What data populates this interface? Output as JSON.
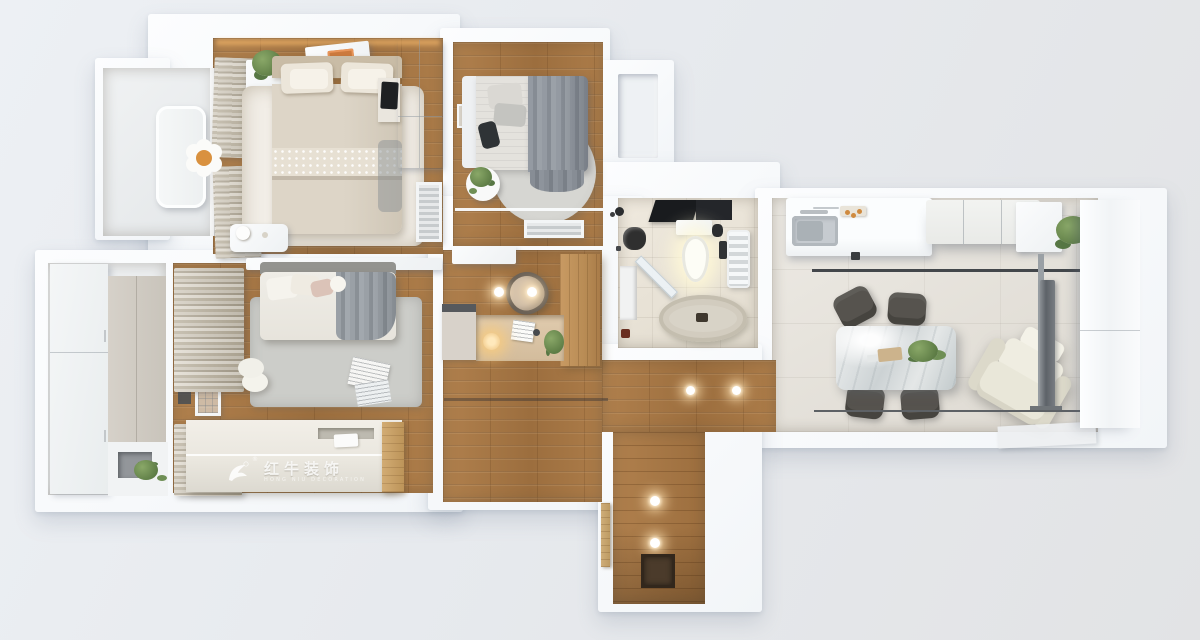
{
  "meta": {
    "scene": "3D top-down rendering of an apartment floor plan",
    "style": "white walls, warm wood and tile floors, photoreal furniture"
  },
  "watermark": {
    "logo": "red-bull-swoosh-logo",
    "registered_mark": "®",
    "brand": "红牛装饰",
    "tagline": "HONG NIU DECORATION"
  },
  "palette": {
    "background": "#e9ecf0",
    "wall": "#f8fafc",
    "wood_floor": "#a87846",
    "bathroom_tile": "#eae4d9",
    "living_tile": "#e7e4de",
    "balcony_floor": "#eceef0",
    "white_rug": "#f2eee7",
    "gray_rug": "#cbcbc7",
    "bed_beige": "#d7cec0",
    "blanket_gray": "#8e949a",
    "marble_table": "#dfe3e4",
    "chair_dark": "#56534e",
    "recliner_cream": "#edebe0",
    "accent_orange": "#cd7a3e",
    "greenery": "#6b8a50",
    "fixture_black": "#26282a",
    "watermark_text": "rgba(255,255,255,0.8)"
  },
  "rooms": [
    {
      "id": "master-bedroom",
      "label": "Master bedroom",
      "floor": "wood",
      "contents": [
        "double-bed",
        "pillows",
        "white-area-rug",
        "wardrobe",
        "bedside-shelf",
        "tablet",
        "curtains",
        "ceiling-light-panel",
        "led-cove-light",
        "potted-plant",
        "air-conditioner-grille",
        "low-side-table"
      ]
    },
    {
      "id": "north-balcony",
      "label": "North balcony",
      "floor": "light-tile",
      "contents": [
        "lounge-bench",
        "flower-stool"
      ]
    },
    {
      "id": "second-bedroom",
      "label": "Second bedroom",
      "floor": "wood",
      "contents": [
        "single-bed",
        "gray-striped-blanket",
        "round-rug",
        "round-side-table",
        "potted-plant",
        "wall-art",
        "window-sill",
        "floor-vent-grille"
      ]
    },
    {
      "id": "bathroom",
      "label": "Bathroom",
      "floor": "beige-tile",
      "contents": [
        "ceiling-exhaust",
        "toilet",
        "black-wash-basin",
        "diagonal-shower-screen",
        "corner-shelf",
        "towel-radiator",
        "oval-bath-mat"
      ]
    },
    {
      "id": "kitchen",
      "label": "Kitchen",
      "floor": "tile",
      "contents": [
        "counter-with-sink",
        "faucet",
        "breakfast-tray",
        "upper-cabinets",
        "corner-cabinet",
        "divider-rail",
        "potted-plant"
      ]
    },
    {
      "id": "living-dining",
      "label": "Living / dining room",
      "floor": "large-tile",
      "contents": [
        "marble-dining-table",
        "dining-chairs-x4",
        "table-plant",
        "serving-tray",
        "recliner-chair",
        "tv-on-floor-stand",
        "white-floor-mat",
        "storage-door-panel",
        "baseboard-rail"
      ]
    },
    {
      "id": "third-bedroom",
      "label": "Bedroom with tatami",
      "floor": "wood",
      "contents": [
        "double-bed",
        "gray-rug",
        "curtains",
        "window-screen",
        "stool",
        "magazines",
        "tatami-platform",
        "wood-step",
        "brand-watermark"
      ]
    },
    {
      "id": "west-balcony",
      "label": "Utility balcony",
      "floor": "light-tile",
      "contents": [
        "sliding-door-cabinet",
        "wall-panel",
        "counter-niche",
        "potted-plant"
      ]
    },
    {
      "id": "study-nook",
      "label": "Study nook / hallway",
      "floor": "wood",
      "contents": [
        "built-in-desk",
        "desk-lamp",
        "papers",
        "desk-plant",
        "curved-chair",
        "wooden-wardrobe",
        "low-cabinet",
        "ceiling-spotlights"
      ]
    },
    {
      "id": "entry-hall",
      "label": "Entry hall",
      "floor": "wood",
      "contents": [
        "ceiling-spotlights",
        "open-door-leaf",
        "doormat"
      ]
    }
  ]
}
